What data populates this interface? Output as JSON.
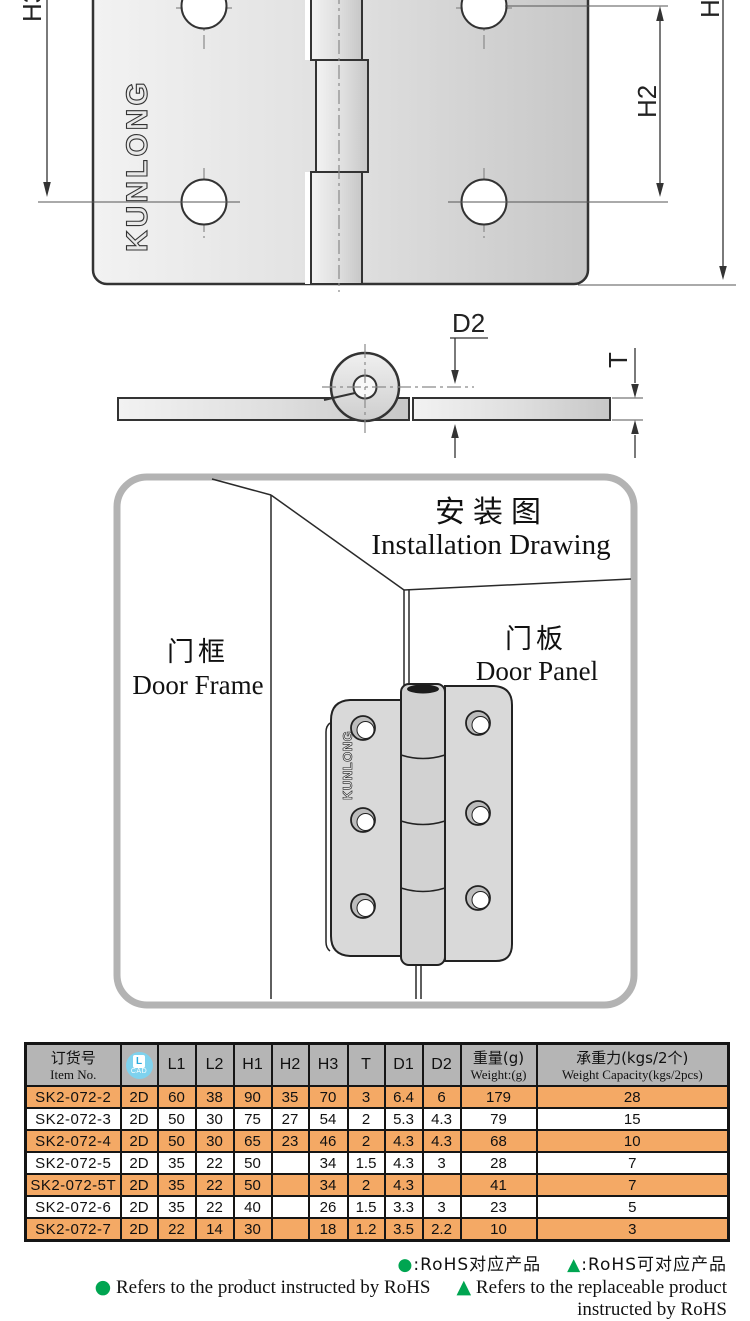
{
  "colors": {
    "accent_orange": "#f4a965",
    "header_gray": "#b5b5b5",
    "rohs_green": "#00a551",
    "cad_blue": "#7fd2ee",
    "panel_border_gray": "#b3b3b3"
  },
  "figures": {
    "front": {
      "dim_left": "H3",
      "dim_right": "H2",
      "dim_far_right": "H",
      "brand": "KUNLONG"
    },
    "side": {
      "dim_diameter": "D2",
      "dim_thickness": "T"
    }
  },
  "installation": {
    "title_cn": "安装图",
    "title_en": "Installation Drawing",
    "door_frame_cn": "门框",
    "door_frame_en": "Door Frame",
    "door_panel_cn": "门板",
    "door_panel_en": "Door Panel",
    "brand": "KUNLONG"
  },
  "table": {
    "columns": [
      {
        "key": "item",
        "type": "bilingual",
        "cn": "订货号",
        "en": "Item No."
      },
      {
        "key": "cad",
        "type": "icon",
        "icon": "cad-icon",
        "letter": "L",
        "caption": "CAD"
      },
      {
        "key": "l1",
        "type": "plain",
        "label": "L1"
      },
      {
        "key": "l2",
        "type": "plain",
        "label": "L2"
      },
      {
        "key": "h1",
        "type": "plain",
        "label": "H1"
      },
      {
        "key": "h2",
        "type": "plain",
        "label": "H2"
      },
      {
        "key": "h3",
        "type": "plain",
        "label": "H3"
      },
      {
        "key": "t",
        "type": "plain",
        "label": "T"
      },
      {
        "key": "d1",
        "type": "plain",
        "label": "D1"
      },
      {
        "key": "d2",
        "type": "plain",
        "label": "D2"
      },
      {
        "key": "weight",
        "type": "bilingual",
        "cn": "重量(g)",
        "en": "Weight:(g)"
      },
      {
        "key": "capacity",
        "type": "bilingual",
        "cn": "承重力(kgs/2个)",
        "en": "Weight Capacity(kgs/2pcs)"
      }
    ],
    "rows": [
      {
        "item": "SK2-072-2",
        "cad": "2D",
        "l1": "60",
        "l2": "38",
        "h1": "90",
        "h2": "35",
        "h3": "70",
        "t": "3",
        "d1": "6.4",
        "d2": "6",
        "weight": "179",
        "capacity": "28",
        "highlight": true
      },
      {
        "item": "SK2-072-3",
        "cad": "2D",
        "l1": "50",
        "l2": "30",
        "h1": "75",
        "h2": "27",
        "h3": "54",
        "t": "2",
        "d1": "5.3",
        "d2": "4.3",
        "weight": "79",
        "capacity": "15",
        "highlight": false
      },
      {
        "item": "SK2-072-4",
        "cad": "2D",
        "l1": "50",
        "l2": "30",
        "h1": "65",
        "h2": "23",
        "h3": "46",
        "t": "2",
        "d1": "4.3",
        "d2": "4.3",
        "weight": "68",
        "capacity": "10",
        "highlight": true
      },
      {
        "item": "SK2-072-5",
        "cad": "2D",
        "l1": "35",
        "l2": "22",
        "h1": "50",
        "h2": null,
        "h3": "34",
        "t": "1.5",
        "d1": "4.3",
        "d2": "3",
        "weight": "28",
        "capacity": "7",
        "highlight": false
      },
      {
        "item": "SK2-072-5T",
        "cad": "2D",
        "l1": "35",
        "l2": "22",
        "h1": "50",
        "h2": null,
        "h3": "34",
        "t": "2",
        "d1": "4.3",
        "d2": null,
        "weight": "41",
        "capacity": "7",
        "highlight": true
      },
      {
        "item": "SK2-072-6",
        "cad": "2D",
        "l1": "35",
        "l2": "22",
        "h1": "40",
        "h2": null,
        "h3": "26",
        "t": "1.5",
        "d1": "3.3",
        "d2": "3",
        "weight": "23",
        "capacity": "5",
        "highlight": false
      },
      {
        "item": "SK2-072-7",
        "cad": "2D",
        "l1": "22",
        "l2": "14",
        "h1": "30",
        "h2": null,
        "h3": "18",
        "t": "1.2",
        "d1": "3.5",
        "d2": "2.2",
        "weight": "10",
        "capacity": "3",
        "highlight": true
      }
    ]
  },
  "legend": {
    "cn": [
      {
        "symbol": "●",
        "text": ":RoHS对应产品"
      },
      {
        "symbol": "▲",
        "text": ":RoHS可对应产品"
      }
    ],
    "en": [
      {
        "symbol": "●",
        "text": "Refers to the product instructed by RoHS"
      },
      {
        "symbol": "▲",
        "text": "Refers to the replaceable product instructed by RoHS"
      }
    ]
  }
}
